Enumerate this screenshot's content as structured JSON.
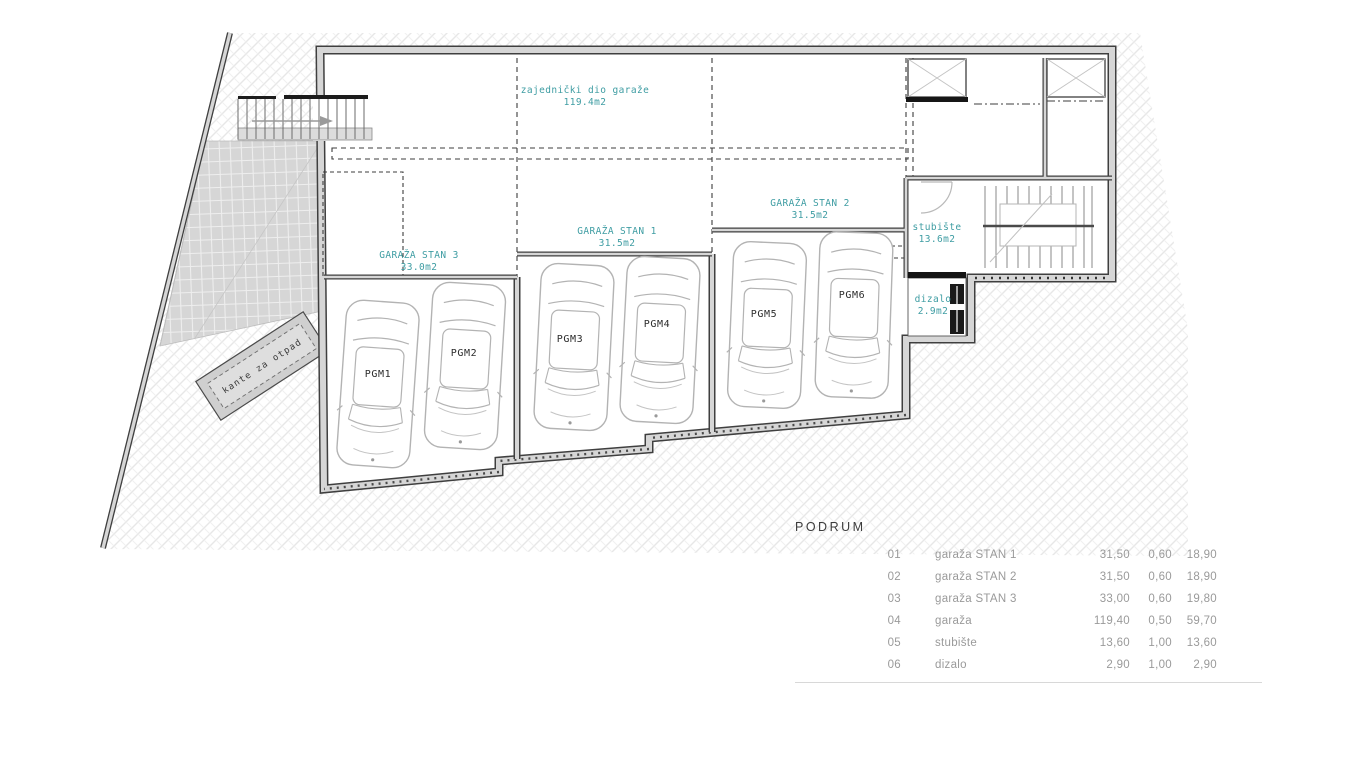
{
  "plan": {
    "rooms": {
      "common": {
        "name": "zajednički dio garaže",
        "area": "119.4m2"
      },
      "stan1": {
        "name": "GARAŽA STAN 1",
        "area": "31.5m2"
      },
      "stan2": {
        "name": "GARAŽA STAN 2",
        "area": "31.5m2"
      },
      "stan3": {
        "name": "GARAŽA STAN 3",
        "area": "33.0m2"
      },
      "stubiste": {
        "name": "stubište",
        "area": "13.6m2"
      },
      "dizalo": {
        "name": "dizalo",
        "area": "2.9m2"
      },
      "waste": {
        "name": "kante za otpad"
      }
    },
    "parking": {
      "p1": "PGM1",
      "p2": "PGM2",
      "p3": "PGM3",
      "p4": "PGM4",
      "p5": "PGM5",
      "p6": "PGM6"
    },
    "colors": {
      "label_teal": "#3f9da3",
      "table_gray": "#9a9a9a"
    }
  },
  "table": {
    "title": "PODRUM",
    "rows": [
      {
        "num": "01",
        "name": "garaža STAN 1",
        "v1": "31,50",
        "v2": "0,60",
        "v3": "18,90"
      },
      {
        "num": "02",
        "name": "garaža STAN 2",
        "v1": "31,50",
        "v2": "0,60",
        "v3": "18,90"
      },
      {
        "num": "03",
        "name": "garaža STAN 3",
        "v1": "33,00",
        "v2": "0,60",
        "v3": "19,80"
      },
      {
        "num": "04",
        "name": "garaža",
        "v1": "119,40",
        "v2": "0,50",
        "v3": "59,70"
      },
      {
        "num": "05",
        "name": "stubište",
        "v1": "13,60",
        "v2": "1,00",
        "v3": "13,60"
      },
      {
        "num": "06",
        "name": "dizalo",
        "v1": "2,90",
        "v2": "1,00",
        "v3": "2,90"
      }
    ]
  }
}
